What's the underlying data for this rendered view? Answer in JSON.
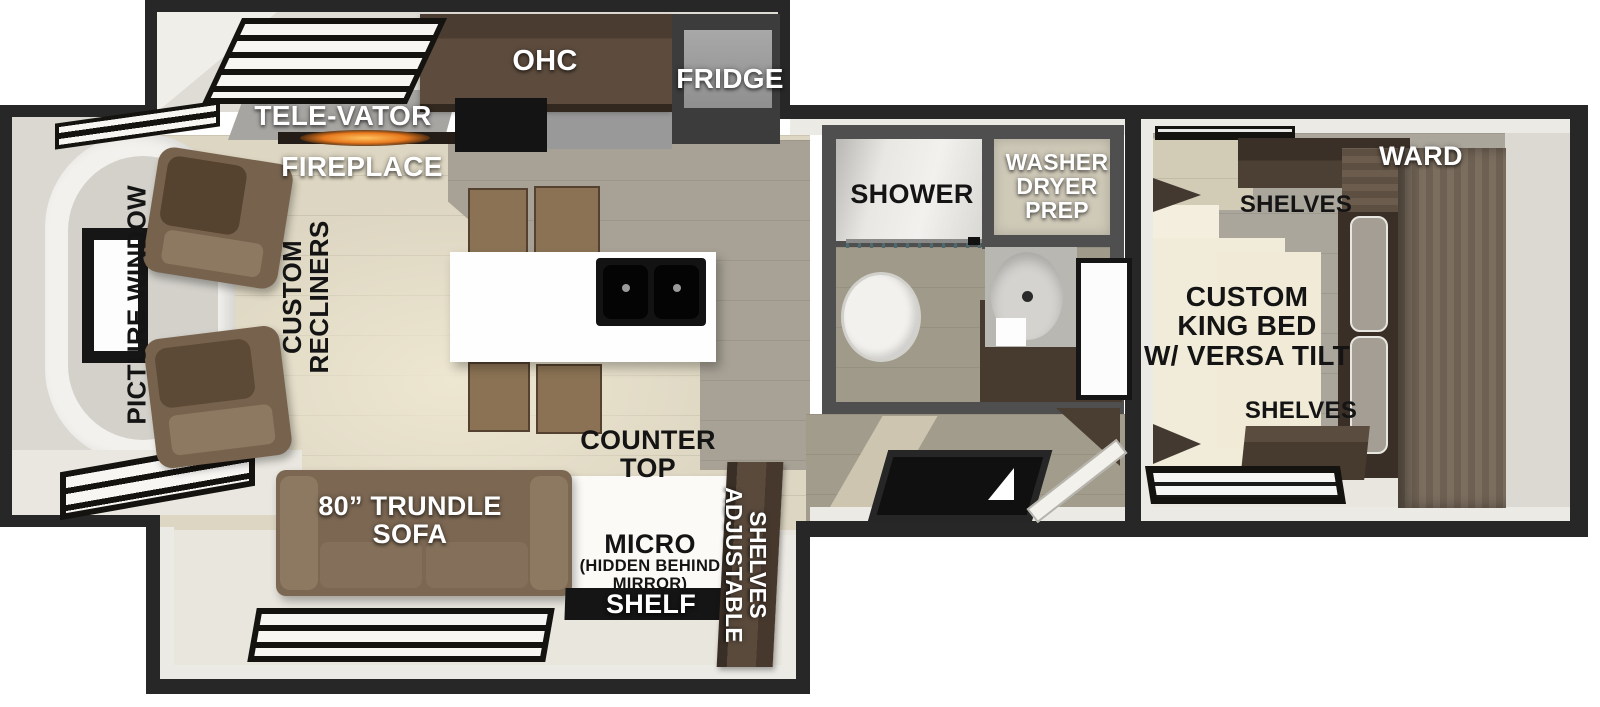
{
  "meta": {
    "type": "rv-travel-trailer-floorplan"
  },
  "palette": {
    "wall": "#272727",
    "wall_inner": "#eceae5",
    "bath_wall": "#4f4f4f",
    "wood_cabinet_dark": "#473b30",
    "floor_light": "#ddd6c2",
    "floor_gray": "#a8a296",
    "furniture_brown": "#7b6752",
    "fire_glow": "#e8791e"
  },
  "slideout": {
    "ohc_label": "OHC",
    "fridge_label": "FRIDGE"
  },
  "kitchen": {
    "televator_label": "TELE-VATOR",
    "fireplace_label": "FIREPLACE",
    "counter_top_lines": [
      "COUNTER",
      "TOP"
    ]
  },
  "living": {
    "picture_window_label": "PICTURE WINDOW",
    "recliners_lines": [
      "CUSTOM",
      "RECLINERS"
    ],
    "sofa_lines": [
      "80” TRUNDLE",
      "SOFA"
    ],
    "micro_label": "MICRO",
    "micro_sub_lines": [
      "(HIDDEN BEHIND",
      "MIRROR)"
    ],
    "shelf_label": "SHELF",
    "adjustable_lines": [
      "ADJUSTABLE",
      "SHELVES"
    ]
  },
  "bathroom": {
    "shower_label": "SHOWER",
    "washer_lines": [
      "WASHER",
      "DRYER",
      "PREP"
    ]
  },
  "bedroom": {
    "ward_label": "WARD",
    "shelves_top_label": "SHELVES",
    "king_bed_lines": [
      "CUSTOM",
      "KING BED",
      "W/ VERSA TILT"
    ],
    "shelves_bottom_label": "SHELVES"
  }
}
